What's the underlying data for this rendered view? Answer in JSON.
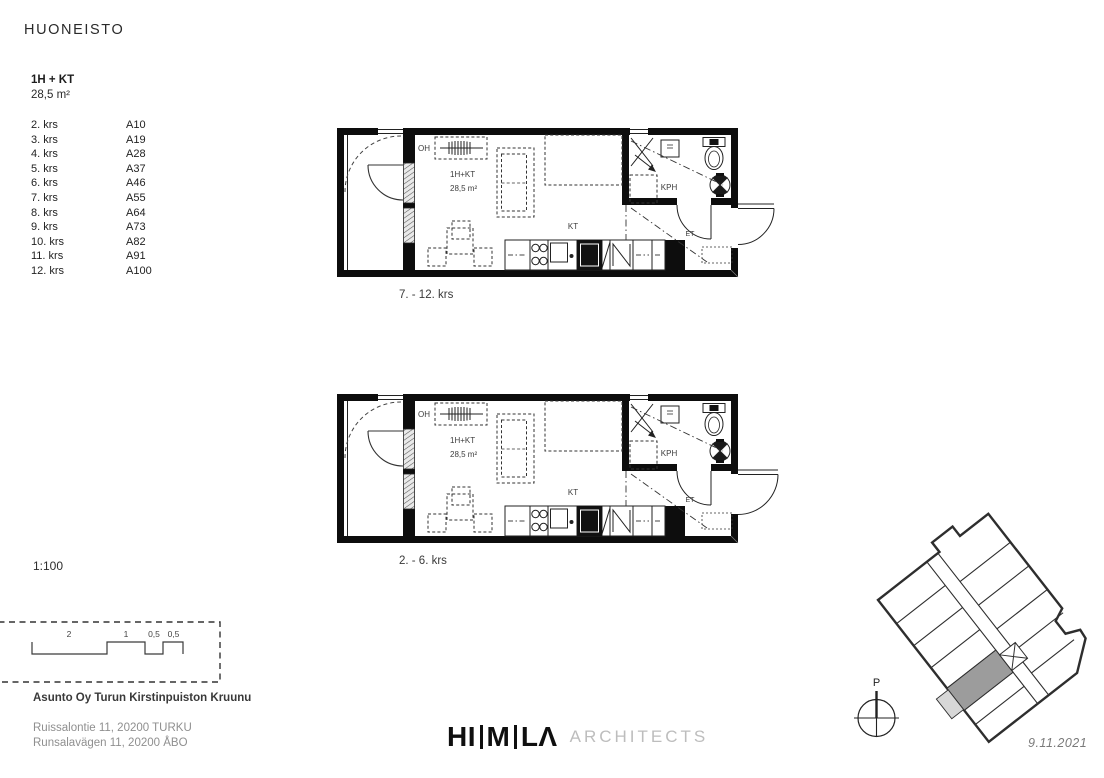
{
  "title": "HUONEISTO",
  "apartment": {
    "type": "1H + KT",
    "area": "28,5 m²",
    "floors": [
      {
        "floor": "2. krs",
        "unit": "A10"
      },
      {
        "floor": "3. krs",
        "unit": "A19"
      },
      {
        "floor": "4. krs",
        "unit": "A28"
      },
      {
        "floor": "5. krs",
        "unit": "A37"
      },
      {
        "floor": "6. krs",
        "unit": "A46"
      },
      {
        "floor": "7. krs",
        "unit": "A55"
      },
      {
        "floor": "8. krs",
        "unit": "A64"
      },
      {
        "floor": "9. krs",
        "unit": "A73"
      },
      {
        "floor": "10. krs",
        "unit": "A82"
      },
      {
        "floor": "11. krs",
        "unit": "A91"
      },
      {
        "floor": "12. krs",
        "unit": "A100"
      }
    ]
  },
  "plans": [
    {
      "caption": "7. - 12. krs",
      "labels": {
        "oh": "OH",
        "type": "1H+KT",
        "area": "28,5 m²",
        "kt": "KT",
        "kph": "KPH",
        "et": "ET"
      }
    },
    {
      "caption": "2. - 6. krs",
      "labels": {
        "oh": "OH",
        "type": "1H+KT",
        "area": "28,5 m²",
        "kt": "KT",
        "kph": "KPH",
        "et": "ET"
      }
    }
  ],
  "scale": {
    "ratio": "1:100",
    "bar_labels": [
      "2",
      "1",
      "0,5",
      "0,5"
    ]
  },
  "project": {
    "name": "Asunto Oy Turun Kirstinpuiston Kruunu",
    "address_fi": "Ruissalontie 11, 20200 TURKU",
    "address_sv": "Runsalavägen 11, 20200 ÅBO"
  },
  "logo": {
    "part1": "HI",
    "part2": "M",
    "part3": "LΛ",
    "suffix": "ARCHITECTS"
  },
  "site_plan": {
    "north_label": "P",
    "date": "9.11.2021"
  },
  "colors": {
    "ink": "#111111",
    "gray_text": "#8f8f8f",
    "logo_gray": "#bdbdbd",
    "unit_highlight": "#9c9c9c",
    "balcony_highlight": "#d7d7d7"
  }
}
